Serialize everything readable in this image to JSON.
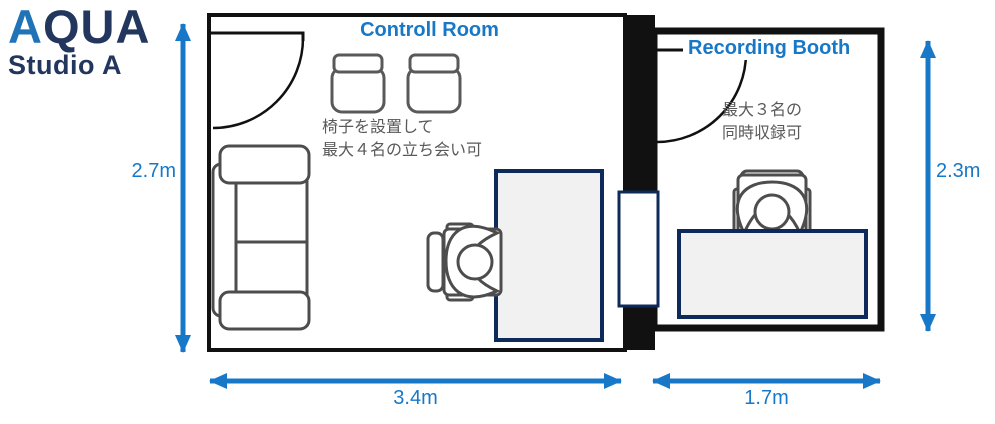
{
  "logo": {
    "brand_accent": "A",
    "brand_rest": "QUA",
    "studio": "Studio A"
  },
  "control_room": {
    "title": "Controll Room",
    "note_line1": "椅子を設置して",
    "note_line2": "最大４名の立ち会い可",
    "width": "3.4m",
    "height": "2.7m"
  },
  "recording_booth": {
    "title": "Recording Booth",
    "note_line1": "最大３名の",
    "note_line2": "同時収録可",
    "width": "1.7m",
    "height": "2.3m"
  },
  "colors": {
    "accent_blue": "#1878C8",
    "logo_navy": "#22365E",
    "logo_blue": "#2173B8",
    "wall_black": "#111111",
    "furniture_gray": "#4D4D4D",
    "stool_gray": "#595959",
    "desk_fill": "#F1F1F2",
    "desk_border_navy": "#0E2A5A",
    "note_gray": "#595959"
  }
}
